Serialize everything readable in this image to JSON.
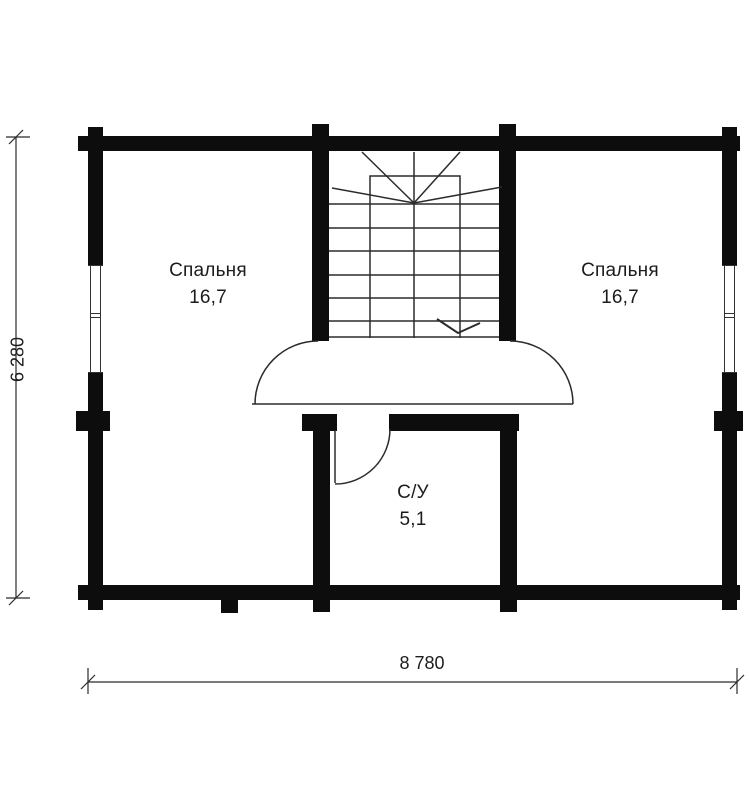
{
  "rooms": {
    "bedroom_left": {
      "label": "Спальня",
      "area": "16,7"
    },
    "bedroom_right": {
      "label": "Спальня",
      "area": "16,7"
    },
    "bathroom": {
      "label": "С/У",
      "area": "5,1"
    }
  },
  "dimensions": {
    "height_total": "6 280",
    "width_total": "8 780"
  },
  "colors": {
    "wall": "#0d0d0d",
    "line": "#2b2b2b",
    "background": "#ffffff"
  }
}
